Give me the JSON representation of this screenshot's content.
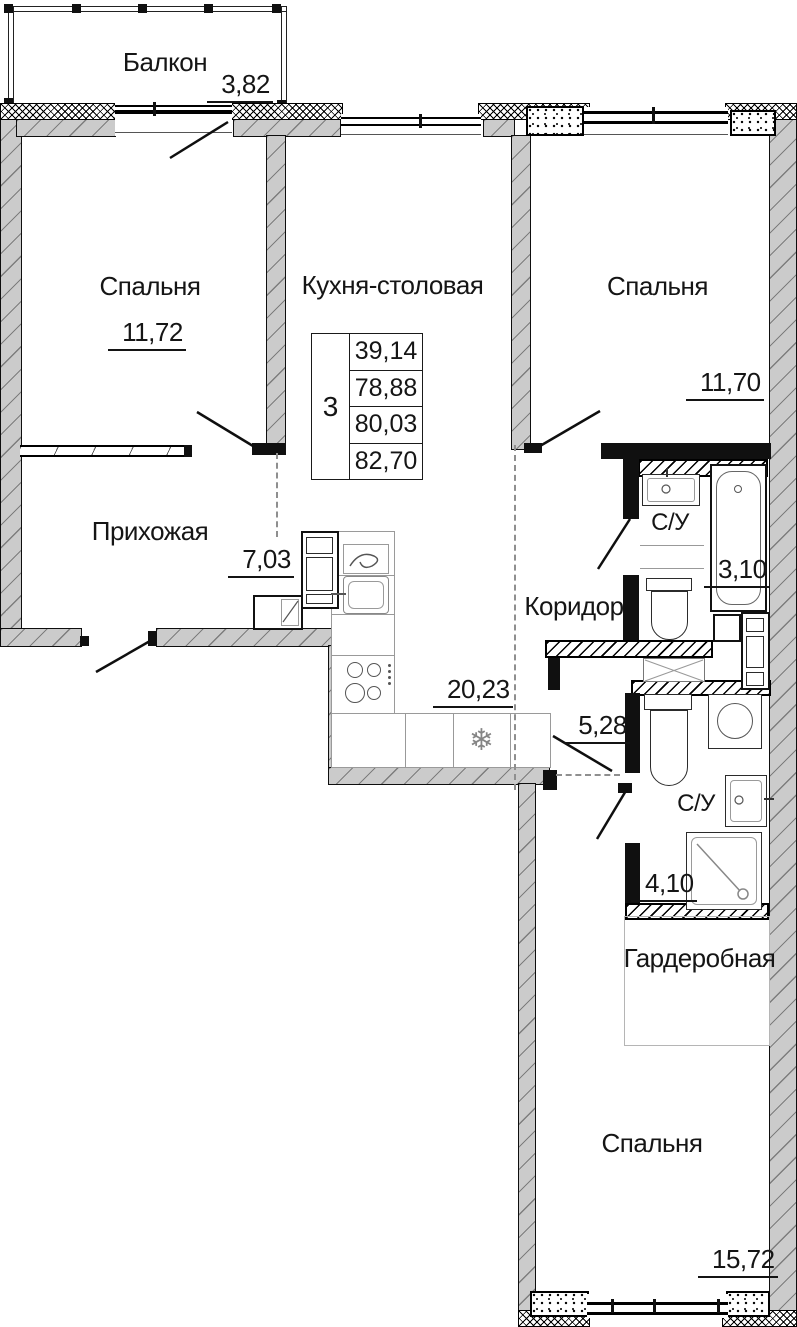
{
  "rooms": {
    "balcony": {
      "label": "Балкон",
      "area": "3,82"
    },
    "bedroom_top_left": {
      "label": "Спальня",
      "area": "11,72"
    },
    "kitchen_dining": {
      "label": "Кухня-столовая",
      "area": "20,23"
    },
    "bedroom_top_right": {
      "label": "Спальня",
      "area": "11,70"
    },
    "hallway": {
      "label": "Прихожая",
      "area": "7,03"
    },
    "corridor": {
      "label": "Коридор",
      "area": "5,28"
    },
    "bathroom_top": {
      "label": "С/У",
      "area": "3,10"
    },
    "bathroom_bottom": {
      "label": "С/У",
      "area": "4,10"
    },
    "wardrobe": {
      "label": "Гардеробная"
    },
    "bedroom_bottom": {
      "label": "Спальня",
      "area": "15,72"
    }
  },
  "info_table": {
    "rooms_count": "3",
    "values": [
      "39,14",
      "78,88",
      "80,03",
      "82,70"
    ]
  },
  "symbols": {
    "fridge": "❄"
  },
  "colors": {
    "wall_fill": "#cbcbcb",
    "line": "#111111",
    "furniture_line": "#9a9a9a",
    "zone_dash": "#8f8f8f"
  }
}
